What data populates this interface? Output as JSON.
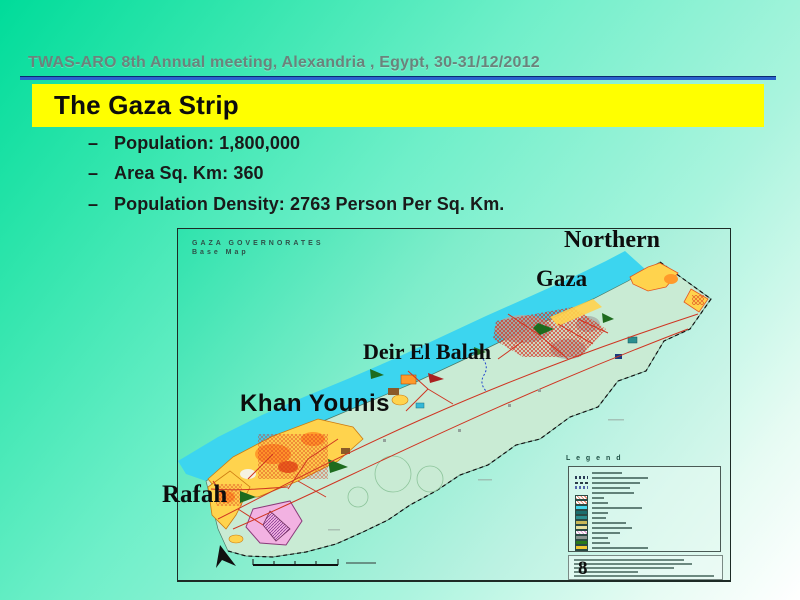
{
  "slide": {
    "header_text": "TWAS-ARO 8th Annual meeting, Alexandria , Egypt, 30-31/12/2012",
    "title": "The Gaza Strip",
    "bullets": [
      {
        "marker": "–",
        "text": "Population: 1,800,000"
      },
      {
        "marker": "–",
        "text": "Area Sq. Km: 360"
      },
      {
        "marker": "–",
        "text": "Population Density: 2763 Person Per Sq. Km."
      }
    ],
    "page_number": "8",
    "colors": {
      "background_start": "#00DC9A",
      "background_end": "#FFFFFF",
      "title_bar": "#FFFF00",
      "divider_blue": "#2A62CC",
      "header_text": "#6B837C"
    }
  },
  "map": {
    "corner_title_line1": "GAZA GOVERNORATES",
    "corner_title_line2": "Base Map",
    "region_labels": [
      {
        "name": "Northern"
      },
      {
        "name": "Gaza"
      },
      {
        "name": "Deir El Balah"
      },
      {
        "name": "Khan Younis"
      },
      {
        "name": "Rafah"
      }
    ],
    "legend": {
      "title": "L e g e n d",
      "items": [
        {
          "type": "text",
          "color": "#3A5A52",
          "text_w": 30
        },
        {
          "type": "zigzag",
          "color": "#2A3A55",
          "text_w": 56
        },
        {
          "type": "dash",
          "color": "#2A3A45",
          "text_w": 48
        },
        {
          "type": "zigzag",
          "color": "#5566AA",
          "text_w": 38
        },
        {
          "type": "text",
          "color": "#3A5A52",
          "text_w": 42
        },
        {
          "type": "hatch",
          "color": "#E06A50",
          "text_w": 12
        },
        {
          "type": "hatch",
          "color": "#E06A50",
          "text_w": 16
        },
        {
          "type": "swatch",
          "color": "#45D8EE",
          "text_w": 50
        },
        {
          "type": "swatch",
          "color": "#1A6E6E",
          "text_w": 16
        },
        {
          "type": "swatch",
          "color": "#2A8F8F",
          "text_w": 14
        },
        {
          "type": "swatch",
          "color": "#C8B858",
          "text_w": 34
        },
        {
          "type": "swatch",
          "color": "#E8E2A0",
          "text_w": 40
        },
        {
          "type": "hatch",
          "color": "#D885C8",
          "text_w": 28
        },
        {
          "type": "swatch",
          "color": "#8A9490",
          "text_w": 16
        },
        {
          "type": "swatch",
          "color": "#2A7A1A",
          "text_w": 18
        },
        {
          "type": "swatch",
          "color": "#F0C830",
          "text_w": 56
        },
        {
          "type": "swatch",
          "color": "#F8F8F0",
          "text_w": 44
        }
      ]
    },
    "colors": {
      "sea": "#3CD5EF",
      "land": "#C9EBD4",
      "roads": "#CF3522",
      "urban_yellow": "#FFD34D",
      "urban_orange": "#FF9A2A",
      "urban_pink": "#F2B2E2",
      "border_dash": "#111111"
    }
  }
}
